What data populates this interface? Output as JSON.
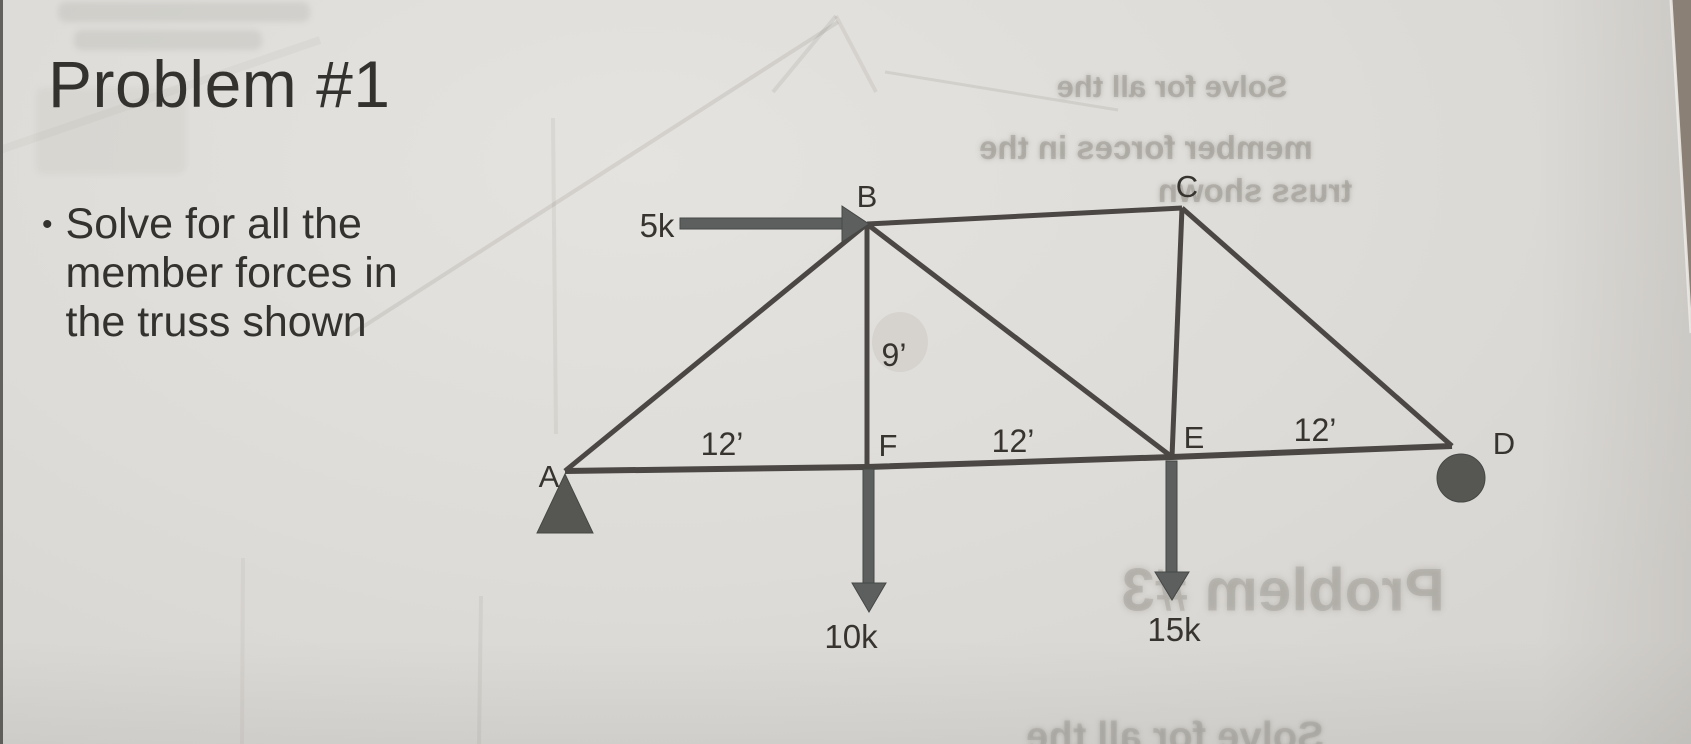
{
  "slide": {
    "title": "Problem #1",
    "bullet_marker": "•",
    "bullet_lines": [
      "Solve for all the",
      "member forces in",
      "the truss shown"
    ]
  },
  "truss": {
    "node_labels": {
      "A": "A",
      "B": "B",
      "C": "C",
      "D": "D",
      "E": "E",
      "F": "F"
    },
    "loads": {
      "at_B": "5k",
      "at_F": "10k",
      "at_E": "15k"
    },
    "dimensions": {
      "AF": "12’",
      "FE": "12’",
      "ED": "12’",
      "BF": "9’"
    },
    "supports": {
      "A": "pin-triangle",
      "D": "roller-circle"
    }
  },
  "ghost_bleedthrough": {
    "top_right_lines": [
      "Solve for all the",
      "member forces in the",
      "truss shown"
    ],
    "bottom_right_title": "Problem #3",
    "bottom_edge_line": "Solve for all the"
  },
  "colors": {
    "paper": "#dedcd8",
    "ink": "#34322f",
    "member": "#4a4744",
    "arrow": "#5c5f5d",
    "desk": "#8a8076"
  }
}
